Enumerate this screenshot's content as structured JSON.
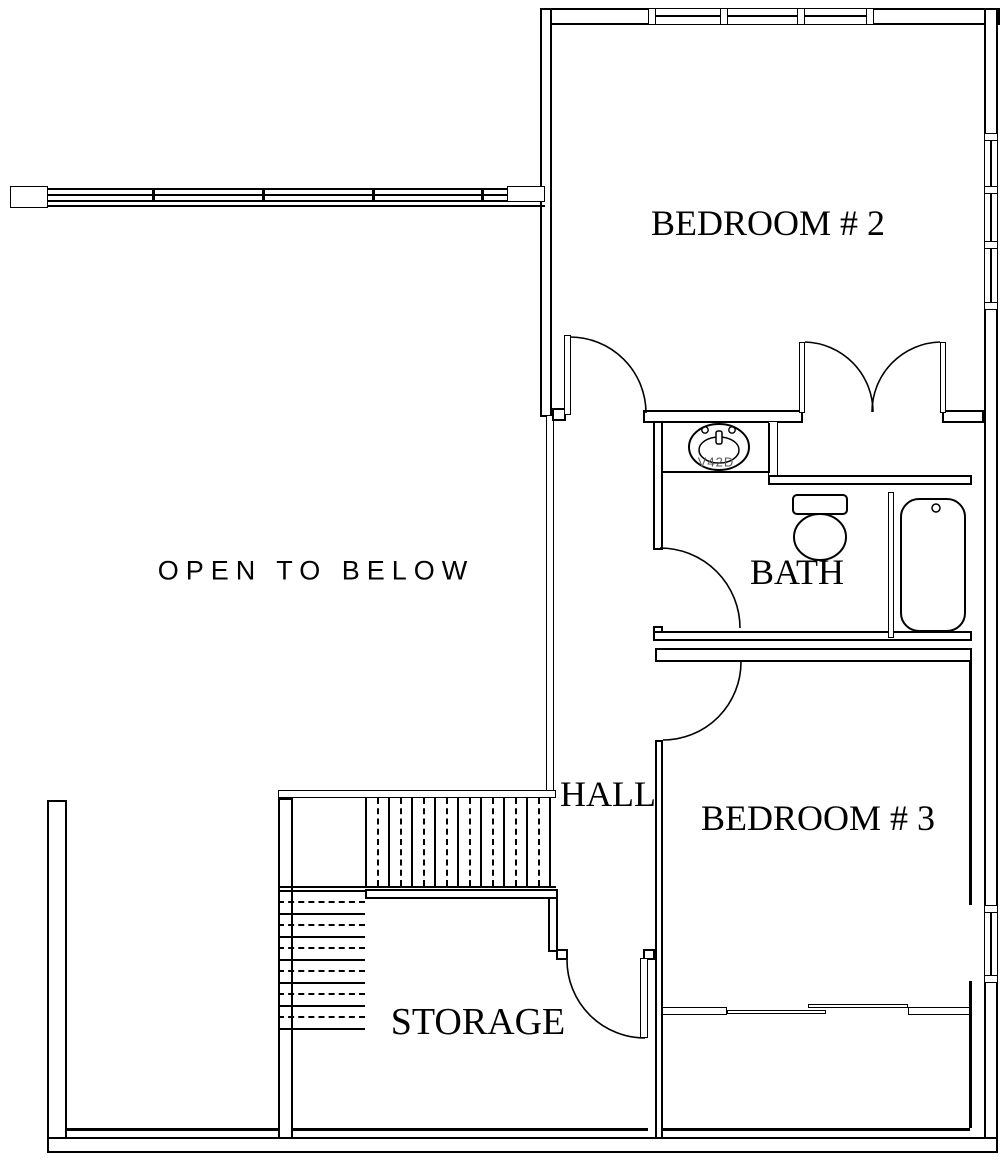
{
  "plan": {
    "rooms": [
      {
        "id": "bedroom2",
        "label": "BEDROOM # 2"
      },
      {
        "id": "bath",
        "label": "BATH"
      },
      {
        "id": "hall",
        "label": "HALL"
      },
      {
        "id": "bedroom3",
        "label": "BEDROOM # 3"
      },
      {
        "id": "storage",
        "label": "STORAGE"
      }
    ],
    "annotations": {
      "open_to_below": "OPEN TO BELOW",
      "sink_model": "V42D"
    },
    "fixtures": [
      "sink",
      "toilet",
      "bathtub",
      "stairs",
      "railing",
      "doors",
      "windows"
    ],
    "colors": {
      "line": "#000000",
      "background": "#ffffff",
      "sink_label": "#5a5a5a"
    }
  }
}
